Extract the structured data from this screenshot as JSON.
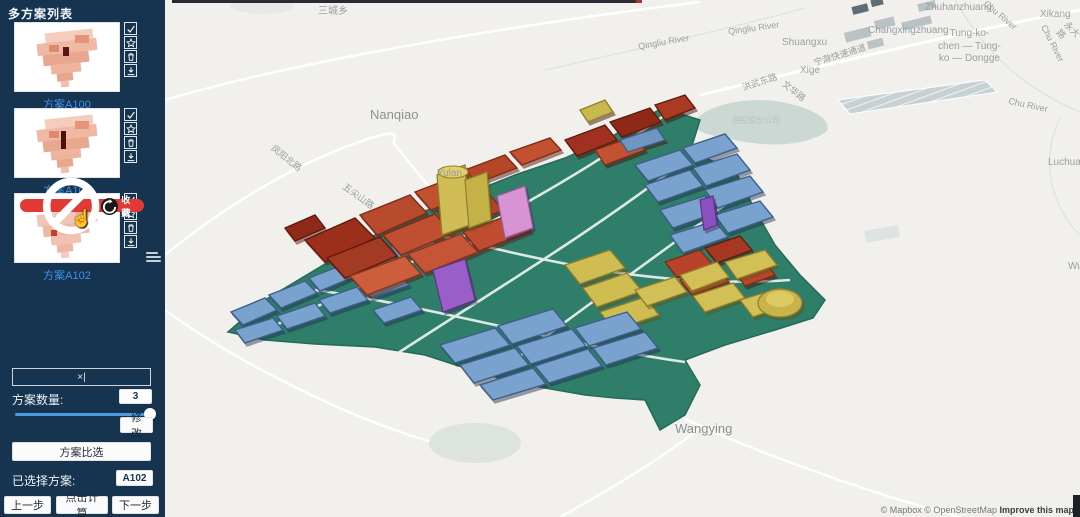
{
  "sidebar": {
    "title": "多方案列表",
    "schemes": [
      {
        "label": "方案A100"
      },
      {
        "label": "方案A101"
      },
      {
        "label": "方案A102",
        "badge": "收藏"
      }
    ],
    "collapse_glyph": "×|",
    "count_label": "方案数量:",
    "count_value": "3",
    "modify_label": "修 改",
    "compare_label": "方案比选",
    "selected_label": "已选择方案:",
    "selected_value": "A102",
    "prev_label": "上一步",
    "calc_label": "点击计算",
    "next_label": "下一步"
  },
  "map": {
    "labels": [
      {
        "text": "三城乡"
      },
      {
        "text": "Nanqiao"
      },
      {
        "text": "Zhuhanzhuang"
      },
      {
        "text": "Xikang"
      },
      {
        "text": "Changxingzhuang"
      },
      {
        "text": "Tung-ko-\nchen — Tung-\nko — Dongge"
      },
      {
        "text": "Chu River"
      },
      {
        "text": "Chu River"
      },
      {
        "text": "Chu River"
      },
      {
        "text": "永大路"
      },
      {
        "text": "宁滁快速通道"
      },
      {
        "text": "Qingliu River"
      },
      {
        "text": "Qingliu River"
      },
      {
        "text": "Shuangxu"
      },
      {
        "text": "Xige"
      },
      {
        "text": "洪武东路"
      },
      {
        "text": "文华路"
      },
      {
        "text": "凤阳北路"
      },
      {
        "text": "五尖山路"
      },
      {
        "text": "Yulan"
      },
      {
        "text": "Wangying"
      },
      {
        "text": "湖投股份公司"
      },
      {
        "text": "Luchuang"
      },
      {
        "text": "Wuga"
      }
    ],
    "attribution": {
      "mapbox": "© Mapbox",
      "osm": "© OpenStreetMap",
      "improve": "Improve this map"
    }
  },
  "colors": {
    "sidebar_bg": "#16334f",
    "scheme_link": "#3f93e8",
    "badge_red": "#e13a34",
    "slider_blue": "#4a9be0",
    "model_blue": "#7aa2cf",
    "model_red": "#c0502f",
    "model_dark_red": "#9c2f1d",
    "model_yellow": "#d2bf55",
    "model_purple": "#9a5ec8",
    "model_pink": "#d793d3",
    "model_green_base": "#2e7e6a",
    "map_bg": "#f1f0ec"
  }
}
